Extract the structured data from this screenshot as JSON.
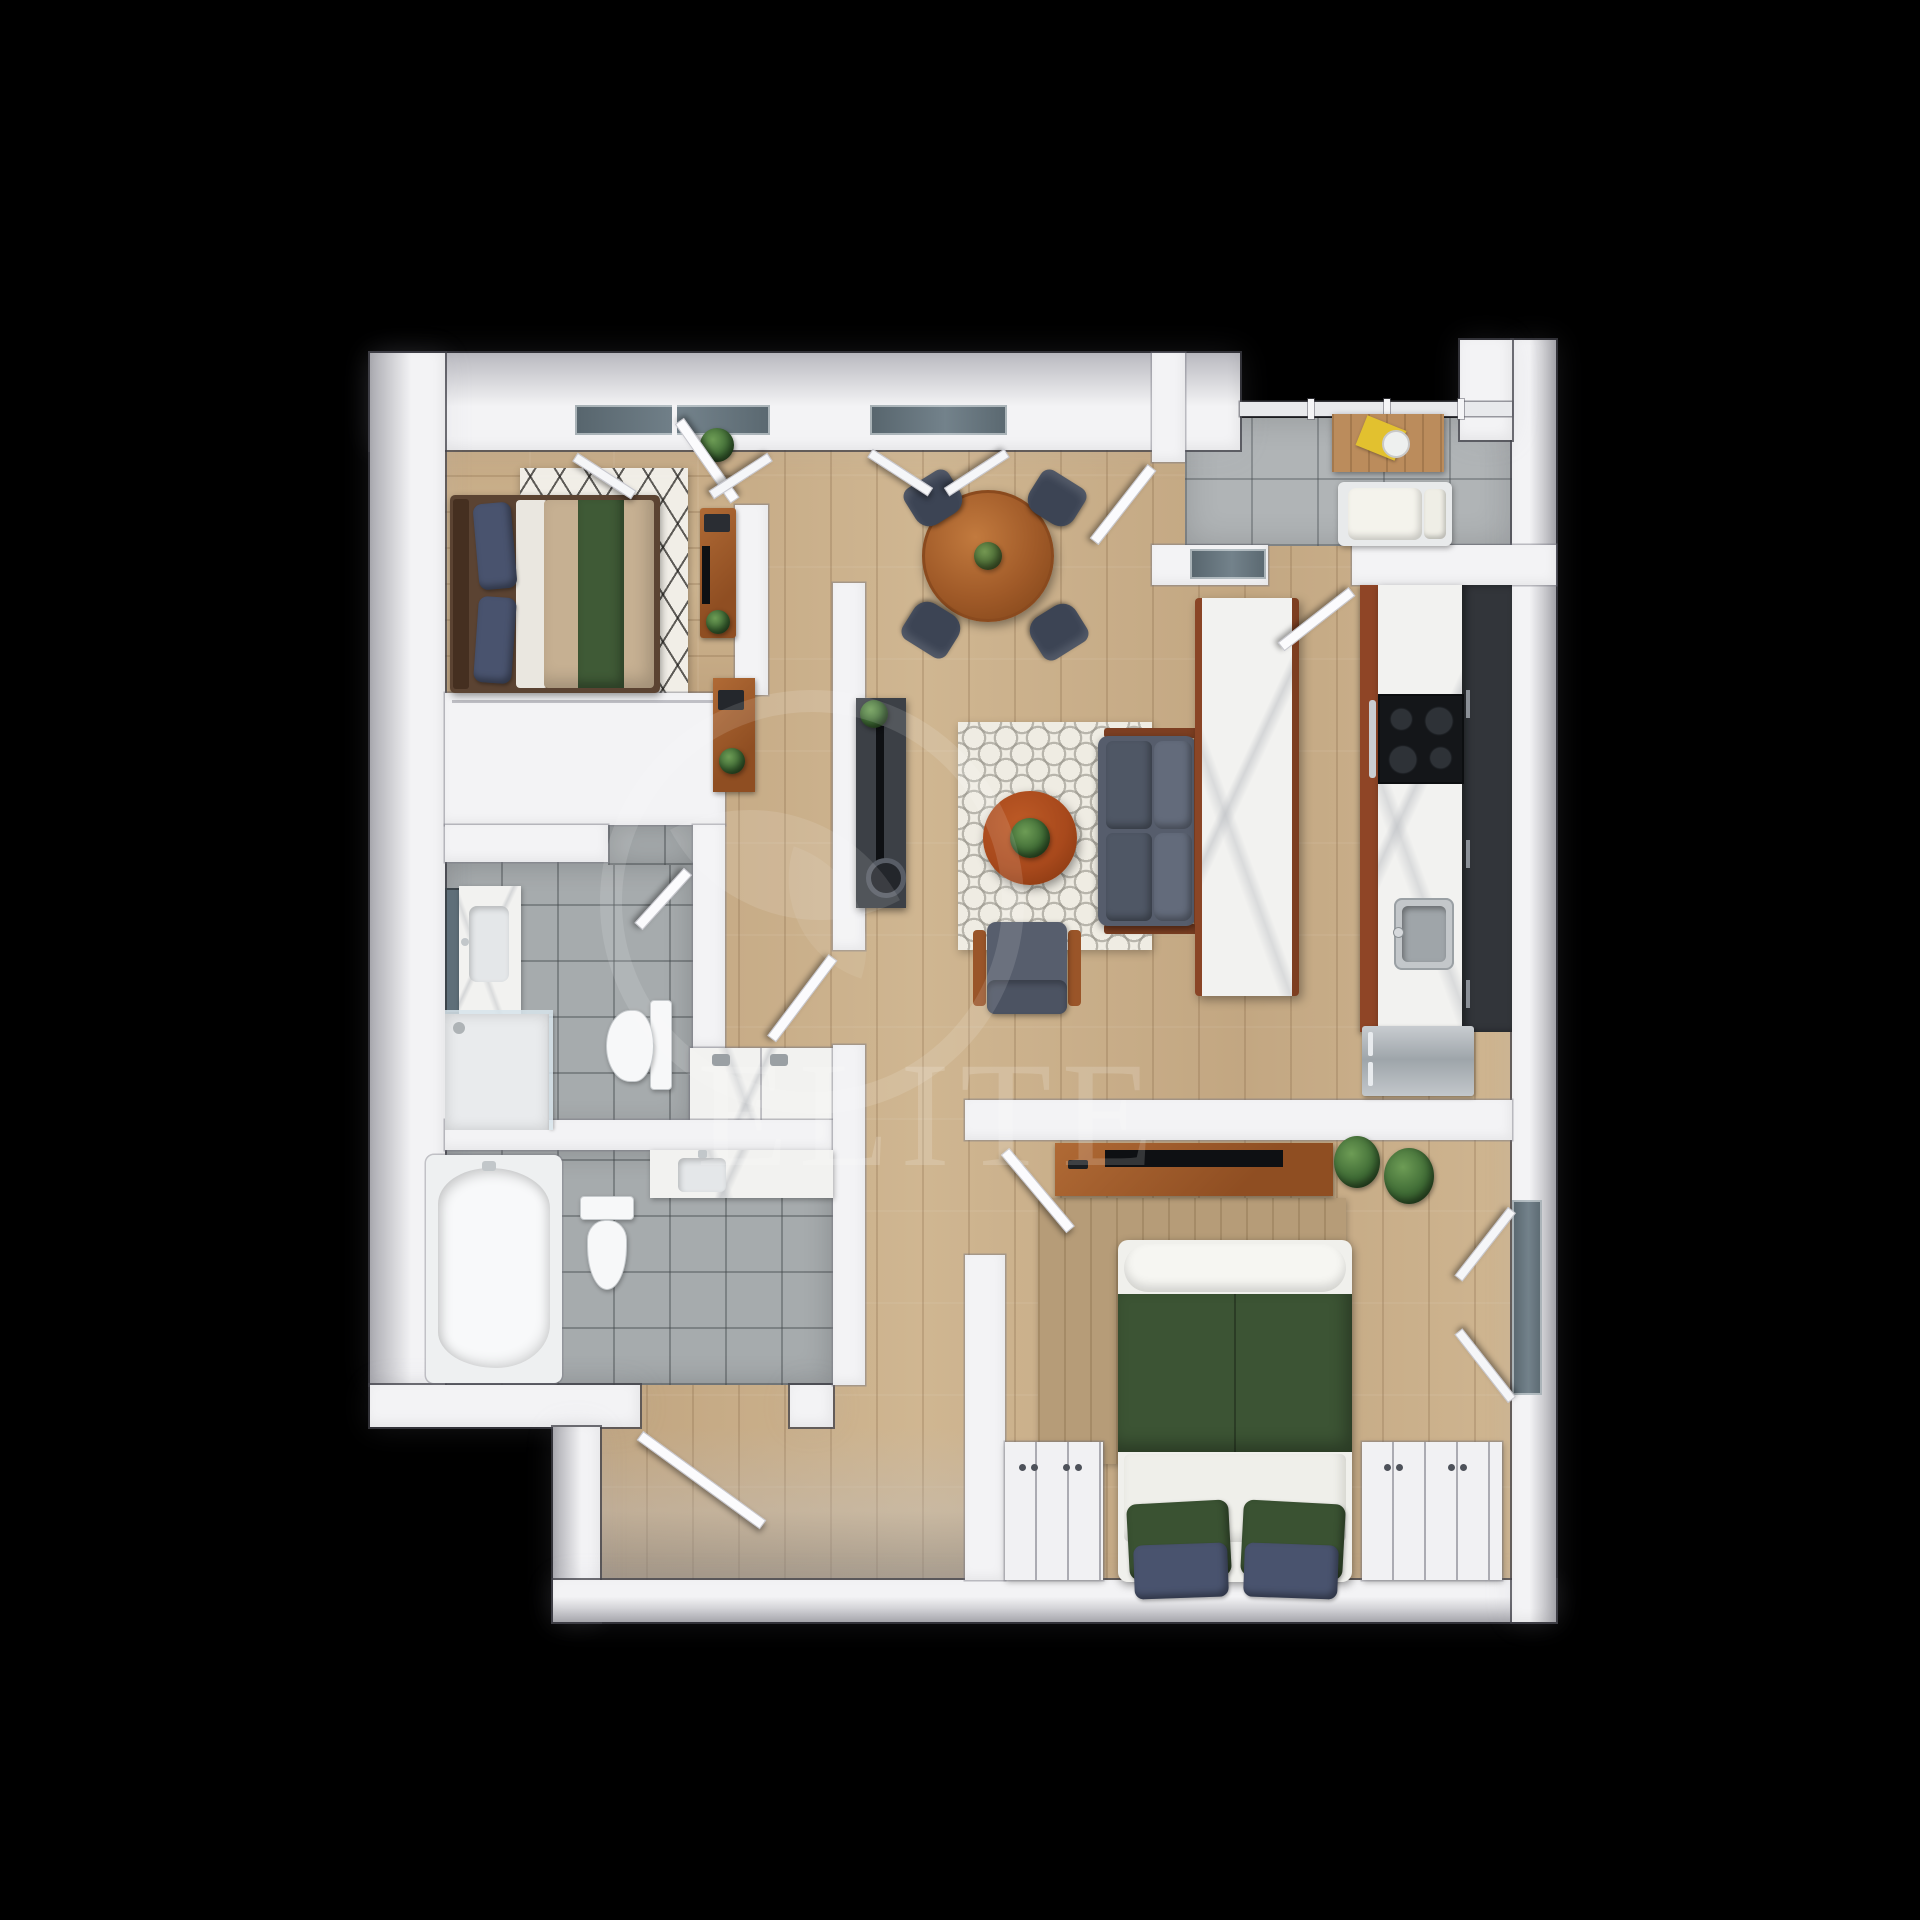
{
  "watermark": {
    "text": "ELITE",
    "logo": "leaf-in-circle-logo"
  },
  "colors": {
    "wall": "#f3f3f5",
    "floorWood": "#ccb28d",
    "tileBalcony": "#b0b4b6",
    "tileBath": "#a6abad",
    "marble": "#f2f2f0",
    "cabinetWood": "#8f4526",
    "darkCabinet": "#32353a",
    "stainless": "#b9bec2",
    "sofaGray": "#565d6c",
    "chairSlate": "#3c4454",
    "tableWood": "#a8612f",
    "coffeeTableWood": "#a8491c",
    "bedTan": "#c6b092",
    "bedGreen": "#3f5a36",
    "blanketGreen": "#3c5434",
    "duvetWhite": "#efefea",
    "pillowNavy": "#49536e",
    "pillowGreen": "#3a5232",
    "plant": "#3f6b35",
    "tvBlack": "#0e1013",
    "glass": "#5d6b73",
    "watermark": "rgba(255,255,255,0.16)",
    "background": "#000000"
  },
  "plan": {
    "type": "3d-top-down-floor-plan",
    "rooms": [
      {
        "id": "bedroom-1",
        "floor": "wood",
        "furniture": [
          "queen-bed",
          "navy-pillows",
          "green-runner",
          "lattice-rug",
          "desk",
          "monitor",
          "plant"
        ]
      },
      {
        "id": "dining-area",
        "floor": "wood",
        "furniture": [
          "round-dining-table",
          "4-chairs",
          "centerpiece-plant"
        ]
      },
      {
        "id": "living-room",
        "floor": "wood",
        "furniture": [
          "sofa",
          "round-coffee-table",
          "armchair",
          "tv-console",
          "tv",
          "soundbar",
          "quatrefoil-rug",
          "hall-console"
        ]
      },
      {
        "id": "kitchen",
        "floor": "wood",
        "furniture": [
          "marble-island",
          "counter-run",
          "cooktop",
          "sink",
          "refrigerator",
          "upper-cabinets"
        ]
      },
      {
        "id": "balcony",
        "floor": "gray-tile",
        "furniture": [
          "wood-table",
          "magazine",
          "plate",
          "lounge-seat",
          "glass-railing"
        ]
      },
      {
        "id": "bathroom-1",
        "floor": "gray-tile",
        "furniture": [
          "vanity-sink",
          "mirror",
          "glass-shower",
          "toilet"
        ]
      },
      {
        "id": "bathroom-2",
        "floor": "gray-tile",
        "furniture": [
          "bathtub",
          "toilet",
          "vanity-sink"
        ]
      },
      {
        "id": "laundry-nook",
        "floor": "wood",
        "furniture": [
          "laundry-counter"
        ]
      },
      {
        "id": "bedroom-2",
        "floor": "wood",
        "furniture": [
          "bed-green-blanket",
          "green-pillows",
          "navy-pillows",
          "tv-dresser",
          "tv",
          "plants",
          "tan-rug",
          "dresser-left",
          "dresser-right",
          "window"
        ]
      },
      {
        "id": "entry-vestibule",
        "floor": "wood",
        "furniture": [
          "entry-door"
        ]
      }
    ],
    "openings": [
      "bedroom-1-window",
      "dining-window",
      "balcony-railing",
      "balcony-door",
      "kitchen-door",
      "bedroom-1-door",
      "bathroom-1-door",
      "hall-door",
      "bedroom-2-door",
      "bedroom-2-window",
      "entry-door"
    ]
  }
}
